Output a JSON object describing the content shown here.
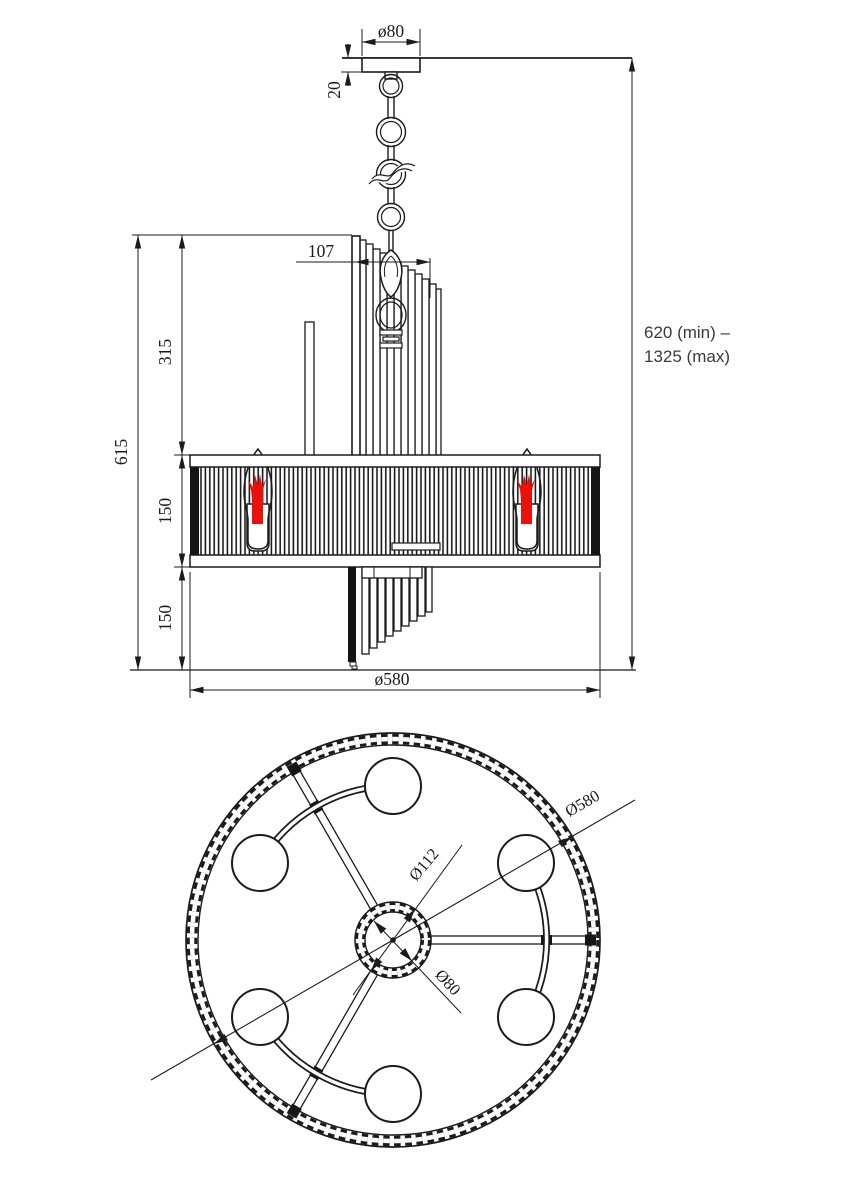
{
  "front_view": {
    "labels": {
      "canopy_diameter": "ø80",
      "canopy_height": "20",
      "cluster_width": "107",
      "upper_section": "315",
      "fixture_height": "615",
      "shade_height": "150",
      "lower_section": "150",
      "shade_diameter": "ø580",
      "suspension_range_line1": "620 (min) –",
      "suspension_range_line2": "1325 (max)"
    }
  },
  "top_view": {
    "labels": {
      "outer_diameter": "Ø580",
      "hub_outer_diameter": "Ø112",
      "hub_inner_diameter": "Ø80"
    }
  },
  "colors": {
    "ink": "#1b1b1b",
    "bulb_red": "#e8120b"
  }
}
